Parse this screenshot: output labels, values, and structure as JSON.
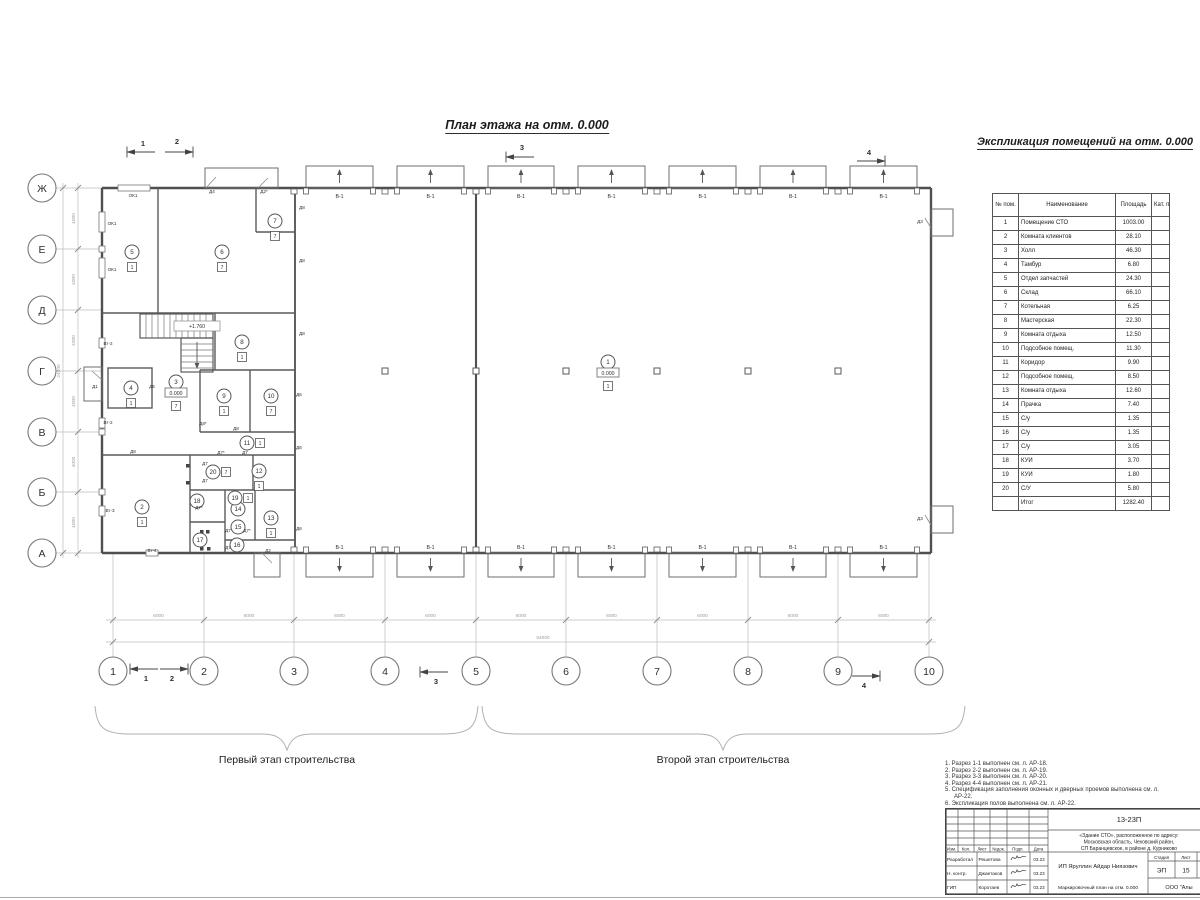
{
  "titles": {
    "plan_title": "План этажа на отм. 0.000",
    "table_title": "Экспликация помещений на отм. 0.000",
    "stage1_label": "Первый этап строительства",
    "stage2_label": "Второй этап строительства"
  },
  "room_table": {
    "headers": [
      "№ пом.",
      "Наименование",
      "Площадь",
      "Кат. пом."
    ],
    "rows": [
      {
        "num": "1",
        "name": "Помещение СТО",
        "area": "1003.00",
        "cat": ""
      },
      {
        "num": "2",
        "name": "Комната клиентов",
        "area": "28.10",
        "cat": ""
      },
      {
        "num": "3",
        "name": "Холл",
        "area": "46.30",
        "cat": ""
      },
      {
        "num": "4",
        "name": "Тамбур",
        "area": "6.80",
        "cat": ""
      },
      {
        "num": "5",
        "name": "Отдел запчастей",
        "area": "24.30",
        "cat": ""
      },
      {
        "num": "6",
        "name": "Склад",
        "area": "66.10",
        "cat": ""
      },
      {
        "num": "7",
        "name": "Котельная",
        "area": "6.25",
        "cat": ""
      },
      {
        "num": "8",
        "name": "Мастерская",
        "area": "22.30",
        "cat": ""
      },
      {
        "num": "9",
        "name": "Комната отдыха",
        "area": "12.50",
        "cat": ""
      },
      {
        "num": "10",
        "name": "Подсобное помещ.",
        "area": "11.30",
        "cat": ""
      },
      {
        "num": "11",
        "name": "Коридор",
        "area": "9.90",
        "cat": ""
      },
      {
        "num": "12",
        "name": "Подсобное помещ.",
        "area": "8.50",
        "cat": ""
      },
      {
        "num": "13",
        "name": "Комната отдыха",
        "area": "12.60",
        "cat": ""
      },
      {
        "num": "14",
        "name": "Прачка",
        "area": "7.40",
        "cat": ""
      },
      {
        "num": "15",
        "name": "С/у",
        "area": "1.35",
        "cat": ""
      },
      {
        "num": "16",
        "name": "С/у",
        "area": "1.35",
        "cat": ""
      },
      {
        "num": "17",
        "name": "С/у",
        "area": "3.05",
        "cat": ""
      },
      {
        "num": "18",
        "name": "КУИ",
        "area": "3.70",
        "cat": ""
      },
      {
        "num": "19",
        "name": "КУИ",
        "area": "1.80",
        "cat": ""
      },
      {
        "num": "20",
        "name": "С/У",
        "area": "5.80",
        "cat": ""
      }
    ],
    "total_label": "Итог",
    "total_area": "1282.40"
  },
  "plan": {
    "grid_cols": [
      "1",
      "2",
      "3",
      "4",
      "5",
      "6",
      "7",
      "8",
      "9",
      "10"
    ],
    "grid_rows": [
      "Ж",
      "Е",
      "Д",
      "Г",
      "В",
      "Б",
      "А"
    ],
    "dim_bay": "6000",
    "dim_total_w": "54000",
    "dim_row": "4000",
    "dim_total_h": "24000",
    "gate_label": "В-1",
    "rooms": [
      {
        "n": "1",
        "x": 608,
        "y": 362,
        "f": "1",
        "fp": "B",
        "lvl": "0.000"
      },
      {
        "n": "2",
        "x": 142,
        "y": 507,
        "f": "1",
        "fp": "b"
      },
      {
        "n": "3",
        "x": 176,
        "y": 382,
        "f": "7",
        "fp": "B",
        "lvl": "0.000"
      },
      {
        "n": "4",
        "x": 131,
        "y": 388,
        "f": "1",
        "fp": "b"
      },
      {
        "n": "5",
        "x": 132,
        "y": 252,
        "f": "1",
        "fp": "b"
      },
      {
        "n": "6",
        "x": 222,
        "y": 252,
        "f": "7",
        "fp": "b"
      },
      {
        "n": "7",
        "x": 275,
        "y": 221,
        "f": "7",
        "fp": "b"
      },
      {
        "n": "8",
        "x": 242,
        "y": 342,
        "f": "1",
        "fp": "b"
      },
      {
        "n": "9",
        "x": 224,
        "y": 396,
        "f": "1",
        "fp": "b"
      },
      {
        "n": "10",
        "x": 271,
        "y": 396,
        "f": "7",
        "fp": "b"
      },
      {
        "n": "11",
        "x": 247,
        "y": 443,
        "f": "1",
        "fp": "r"
      },
      {
        "n": "12",
        "x": 259,
        "y": 471,
        "f": "1",
        "fp": "b"
      },
      {
        "n": "13",
        "x": 271,
        "y": 518,
        "f": "1",
        "fp": "b"
      },
      {
        "n": "14",
        "x": 238,
        "y": 509
      },
      {
        "n": "15",
        "x": 238,
        "y": 527
      },
      {
        "n": "16",
        "x": 237,
        "y": 545
      },
      {
        "n": "17",
        "x": 200,
        "y": 540
      },
      {
        "n": "18",
        "x": 197,
        "y": 501
      },
      {
        "n": "19",
        "x": 235,
        "y": 498,
        "f": "1",
        "fp": "r"
      },
      {
        "n": "20",
        "x": 213,
        "y": 472,
        "f": "7",
        "fp": "r"
      }
    ],
    "levels": [
      {
        "t": "+1.760",
        "x": 197,
        "y": 328
      }
    ],
    "labels": [
      {
        "t": "ОК1",
        "x": 133,
        "y": 197
      },
      {
        "t": "ОК1",
        "x": 112,
        "y": 225
      },
      {
        "t": "ОК1",
        "x": 112,
        "y": 271
      },
      {
        "t": "Д4",
        "x": 212,
        "y": 193
      },
      {
        "t": "Д2*",
        "x": 264,
        "y": 193
      },
      {
        "t": "Д8",
        "x": 302,
        "y": 209
      },
      {
        "t": "Д8",
        "x": 302,
        "y": 262
      },
      {
        "t": "Д8",
        "x": 302,
        "y": 335
      },
      {
        "t": "Д6",
        "x": 299,
        "y": 396
      },
      {
        "t": "Д6",
        "x": 299,
        "y": 449
      },
      {
        "t": "Д6",
        "x": 299,
        "y": 530
      },
      {
        "t": "Вт-2",
        "x": 108,
        "y": 345
      },
      {
        "t": "Вт-2",
        "x": 108,
        "y": 424
      },
      {
        "t": "Вт-3",
        "x": 110,
        "y": 512
      },
      {
        "t": "Вт-4",
        "x": 152,
        "y": 552
      },
      {
        "t": "Д1",
        "x": 95,
        "y": 388
      },
      {
        "t": "Д5",
        "x": 152,
        "y": 388
      },
      {
        "t": "Д8*",
        "x": 203,
        "y": 425
      },
      {
        "t": "Д8",
        "x": 236,
        "y": 430
      },
      {
        "t": "Д7*",
        "x": 221,
        "y": 454
      },
      {
        "t": "Д7",
        "x": 245,
        "y": 454
      },
      {
        "t": "Д8",
        "x": 133,
        "y": 453
      },
      {
        "t": "Д7",
        "x": 205,
        "y": 465
      },
      {
        "t": "Д7",
        "x": 205,
        "y": 482
      },
      {
        "t": "Д7*",
        "x": 199,
        "y": 509
      },
      {
        "t": "Д7",
        "x": 228,
        "y": 532
      },
      {
        "t": "Д7",
        "x": 228,
        "y": 549
      },
      {
        "t": "Д7*",
        "x": 247,
        "y": 532
      },
      {
        "t": "Д2",
        "x": 268,
        "y": 552
      },
      {
        "t": "Д3",
        "x": 920,
        "y": 223
      },
      {
        "t": "Д3",
        "x": 920,
        "y": 520
      }
    ],
    "marks": [
      {
        "n": "1",
        "x": 143,
        "y": 146,
        "d": -1,
        "ly": 152
      },
      {
        "n": "2",
        "x": 177,
        "y": 144,
        "d": 1,
        "ly": 152
      },
      {
        "n": "3",
        "x": 522,
        "y": 150,
        "d": -1,
        "ly": 157
      },
      {
        "n": "4",
        "x": 869,
        "y": 155,
        "d": 1,
        "ly": 161
      },
      {
        "n": "1",
        "x": 146,
        "y": 681,
        "d": -1,
        "ly": 669
      },
      {
        "n": "2",
        "x": 172,
        "y": 681,
        "d": 1,
        "ly": 669
      },
      {
        "n": "3",
        "x": 436,
        "y": 684,
        "d": -1,
        "ly": 672
      },
      {
        "n": "4",
        "x": 864,
        "y": 688,
        "d": 1,
        "ly": 676
      }
    ]
  },
  "notes": [
    "1. Разрез 1-1 выполнен см. л. АР-18.",
    "2. Разрез 2-2 выполнен см. л. АР-19.",
    "3. Разрез 3-3 выполнен см. л. АР-20.",
    "4. Разрез 4-4 выполнен см. л. АР-21.",
    "5. Спецификация заполнения оконных и дверных проемов выполнена см. л. АР-22.",
    "6. Экспликация полов выполнена см. л. АР-22."
  ],
  "stamp": {
    "doc_number": "13-23П",
    "address_lines": [
      "«Здание СТО», расположенное по адресу:",
      "Московская область, Чеховский район,",
      "СП Баранцевское, в районе д. Курниково"
    ],
    "header_cols": [
      "Изм.",
      "Кол.",
      "Лист",
      "№док.",
      "Подп.",
      "Дата"
    ],
    "rows": [
      {
        "role": "Разработал",
        "name": "Решетова",
        "date": "03.23"
      },
      {
        "role": "Н. контр.",
        "name": "Джаетаков",
        "date": "03.23"
      },
      {
        "role": "ГИП",
        "name": "Коротаев",
        "date": "03.23"
      }
    ],
    "client": "ИП Яруллин Айдар Ниязович",
    "stage_label": "Стадия",
    "sheet_label": "Лист",
    "stage": "ЭП",
    "sheet": "15",
    "sheet_title": "Маркировочный план на отм. 0.000",
    "company": "ООО \"Алы"
  }
}
